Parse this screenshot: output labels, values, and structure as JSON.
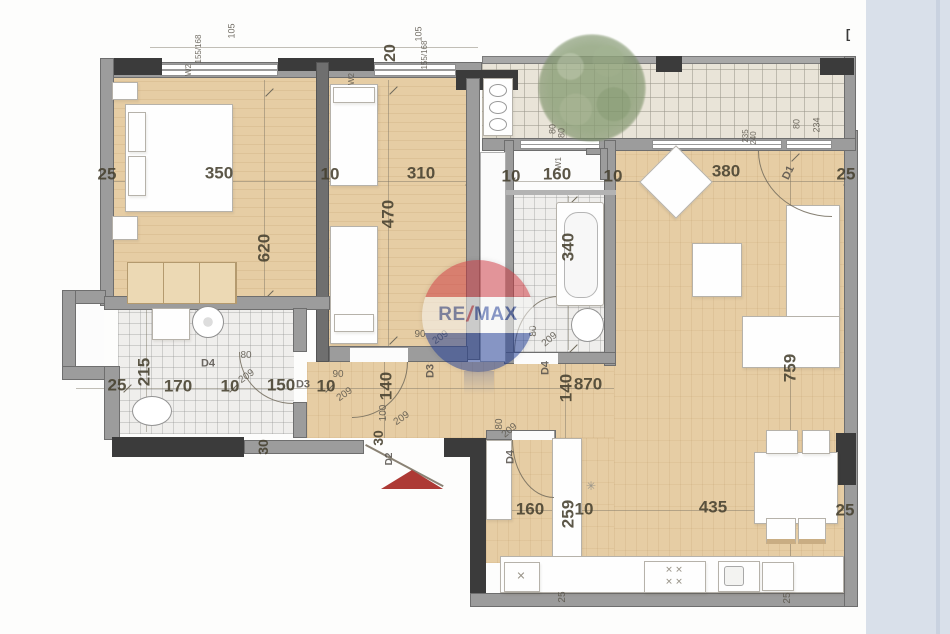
{
  "watermark": {
    "re": "RE",
    "slash": "/",
    "max": "MAX"
  },
  "entrance_marker": "red-triangle",
  "colors": {
    "floor_wood": "#e6cda4",
    "wall_gray": "#9c9c9c",
    "wall_dark": "#3b3b3b",
    "background_band": "#d9e0ea",
    "entrance_arrow": "#ad3a35",
    "watermark_red": "#cd3840",
    "watermark_blue": "#1c3a93",
    "tree_green": "#87a070"
  },
  "labels": [
    {
      "t": "350",
      "x": 219,
      "y": 173,
      "r": 0,
      "s": 17,
      "k": "dim"
    },
    {
      "t": "10",
      "x": 330,
      "y": 174,
      "r": 0,
      "s": 17,
      "k": "dim"
    },
    {
      "t": "310",
      "x": 421,
      "y": 173,
      "r": 0,
      "s": 17,
      "k": "dim"
    },
    {
      "t": "10",
      "x": 511,
      "y": 176,
      "r": 0,
      "s": 17,
      "k": "dim"
    },
    {
      "t": "160",
      "x": 557,
      "y": 174,
      "r": 0,
      "s": 17,
      "k": "dim"
    },
    {
      "t": "10",
      "x": 613,
      "y": 176,
      "r": 0,
      "s": 17,
      "k": "dim"
    },
    {
      "t": "380",
      "x": 726,
      "y": 171,
      "r": 0,
      "s": 17,
      "k": "dim"
    },
    {
      "t": "25",
      "x": 846,
      "y": 174,
      "r": 0,
      "s": 17,
      "k": "dim"
    },
    {
      "t": "25",
      "x": 107,
      "y": 174,
      "r": 0,
      "s": 17,
      "k": "dim"
    },
    {
      "t": "620",
      "x": 264,
      "y": 248,
      "r": -90,
      "s": 17,
      "k": "dim"
    },
    {
      "t": "470",
      "x": 388,
      "y": 214,
      "r": -90,
      "s": 17,
      "k": "dim"
    },
    {
      "t": "340",
      "x": 568,
      "y": 247,
      "r": -90,
      "s": 17,
      "k": "dim"
    },
    {
      "t": "215",
      "x": 144,
      "y": 372,
      "r": -90,
      "s": 17,
      "k": "dim"
    },
    {
      "t": "25",
      "x": 117,
      "y": 385,
      "r": 0,
      "s": 17,
      "k": "dim"
    },
    {
      "t": "170",
      "x": 178,
      "y": 386,
      "r": 0,
      "s": 17,
      "k": "dim"
    },
    {
      "t": "10",
      "x": 230,
      "y": 386,
      "r": 0,
      "s": 17,
      "k": "dim"
    },
    {
      "t": "150",
      "x": 281,
      "y": 385,
      "r": 0,
      "s": 17,
      "k": "dim"
    },
    {
      "t": "10",
      "x": 326,
      "y": 386,
      "r": 0,
      "s": 17,
      "k": "dim"
    },
    {
      "t": "140",
      "x": 386,
      "y": 386,
      "r": -90,
      "s": 17,
      "k": "dim"
    },
    {
      "t": "870",
      "x": 588,
      "y": 384,
      "r": 0,
      "s": 17,
      "k": "dim"
    },
    {
      "t": "140",
      "x": 566,
      "y": 388,
      "r": -90,
      "s": 17,
      "k": "dim"
    },
    {
      "t": "759",
      "x": 790,
      "y": 368,
      "r": -90,
      "s": 17,
      "k": "dim"
    },
    {
      "t": "25",
      "x": 845,
      "y": 510,
      "r": 0,
      "s": 17,
      "k": "dim"
    },
    {
      "t": "160",
      "x": 530,
      "y": 509,
      "r": 0,
      "s": 17,
      "k": "dim"
    },
    {
      "t": "259",
      "x": 568,
      "y": 514,
      "r": -90,
      "s": 17,
      "k": "dim"
    },
    {
      "t": "10",
      "x": 584,
      "y": 509,
      "r": 0,
      "s": 17,
      "k": "dim"
    },
    {
      "t": "435",
      "x": 713,
      "y": 507,
      "r": 0,
      "s": 17,
      "k": "dim"
    },
    {
      "t": "30",
      "x": 263,
      "y": 447,
      "r": -90,
      "s": 14,
      "k": "dim"
    },
    {
      "t": "30",
      "x": 378,
      "y": 438,
      "r": -90,
      "s": 14,
      "k": "dim"
    },
    {
      "t": "20",
      "x": 391,
      "y": 53,
      "r": -90,
      "s": 16,
      "k": "dim"
    },
    {
      "t": "105",
      "x": 232,
      "y": 31,
      "r": -90,
      "s": 9,
      "k": "small"
    },
    {
      "t": "105",
      "x": 419,
      "y": 34,
      "r": -90,
      "s": 9,
      "k": "small"
    },
    {
      "t": "155/168",
      "x": 199,
      "y": 49,
      "r": -90,
      "s": 8,
      "k": "small"
    },
    {
      "t": "155/168",
      "x": 425,
      "y": 55,
      "r": -90,
      "s": 8,
      "k": "small"
    },
    {
      "t": "W2",
      "x": 189,
      "y": 70,
      "r": -90,
      "s": 8,
      "k": "small"
    },
    {
      "t": "W2",
      "x": 352,
      "y": 79,
      "r": -90,
      "s": 8,
      "k": "small"
    },
    {
      "t": "W1",
      "x": 559,
      "y": 163,
      "r": -90,
      "s": 8,
      "k": "small"
    },
    {
      "t": "80",
      "x": 553,
      "y": 129,
      "r": -90,
      "s": 9,
      "k": "small"
    },
    {
      "t": "80",
      "x": 562,
      "y": 133,
      "r": -90,
      "s": 9,
      "k": "small"
    },
    {
      "t": "235",
      "x": 746,
      "y": 136,
      "r": -90,
      "s": 8,
      "k": "small"
    },
    {
      "t": "240",
      "x": 754,
      "y": 138,
      "r": -90,
      "s": 8,
      "k": "small"
    },
    {
      "t": "80",
      "x": 797,
      "y": 124,
      "r": -90,
      "s": 9,
      "k": "small"
    },
    {
      "t": "234",
      "x": 817,
      "y": 125,
      "r": -90,
      "s": 9,
      "k": "small"
    },
    {
      "t": "25",
      "x": 563,
      "y": 597,
      "r": -90,
      "s": 10,
      "k": "small"
    },
    {
      "t": "25",
      "x": 788,
      "y": 598,
      "r": -90,
      "s": 10,
      "k": "small"
    },
    {
      "t": "80",
      "x": 246,
      "y": 356,
      "r": 0,
      "s": 10,
      "k": "small"
    },
    {
      "t": "209",
      "x": 247,
      "y": 377,
      "r": -35,
      "s": 10,
      "k": "small"
    },
    {
      "t": "90",
      "x": 338,
      "y": 375,
      "r": 0,
      "s": 10,
      "k": "small"
    },
    {
      "t": "209",
      "x": 345,
      "y": 395,
      "r": -35,
      "s": 10,
      "k": "small"
    },
    {
      "t": "90",
      "x": 420,
      "y": 335,
      "r": 0,
      "s": 10,
      "k": "small"
    },
    {
      "t": "209",
      "x": 441,
      "y": 338,
      "r": -35,
      "s": 10,
      "k": "small"
    },
    {
      "t": "80",
      "x": 534,
      "y": 331,
      "r": -90,
      "s": 10,
      "k": "small"
    },
    {
      "t": "209",
      "x": 550,
      "y": 340,
      "r": -40,
      "s": 10,
      "k": "small"
    },
    {
      "t": "100",
      "x": 384,
      "y": 413,
      "r": -90,
      "s": 10,
      "k": "small"
    },
    {
      "t": "209",
      "x": 402,
      "y": 419,
      "r": -35,
      "s": 10,
      "k": "small"
    },
    {
      "t": "80",
      "x": 500,
      "y": 424,
      "r": -90,
      "s": 10,
      "k": "small"
    },
    {
      "t": "209",
      "x": 510,
      "y": 431,
      "r": -40,
      "s": 10,
      "k": "small"
    },
    {
      "t": "D4",
      "x": 208,
      "y": 364,
      "r": 0,
      "s": 11,
      "k": "door"
    },
    {
      "t": "D3",
      "x": 303,
      "y": 385,
      "r": 0,
      "s": 11,
      "k": "door"
    },
    {
      "t": "D3",
      "x": 431,
      "y": 371,
      "r": -90,
      "s": 11,
      "k": "door"
    },
    {
      "t": "D4",
      "x": 546,
      "y": 368,
      "r": -90,
      "s": 11,
      "k": "door"
    },
    {
      "t": "D2",
      "x": 390,
      "y": 459,
      "r": -90,
      "s": 10,
      "k": "door"
    },
    {
      "t": "D4",
      "x": 511,
      "y": 457,
      "r": -90,
      "s": 11,
      "k": "door"
    },
    {
      "t": "D1",
      "x": 789,
      "y": 173,
      "r": -65,
      "s": 11,
      "k": "door"
    },
    {
      "t": "[",
      "x": 848,
      "y": 34,
      "r": 0,
      "s": 13,
      "k": "mark"
    },
    {
      "t": "✳",
      "x": 591,
      "y": 486,
      "r": 0,
      "s": 12,
      "k": "sym"
    },
    {
      "t": "✕",
      "x": 521,
      "y": 577,
      "r": 0,
      "s": 11,
      "k": "sym"
    },
    {
      "t": "✕ ✕",
      "x": 674,
      "y": 570,
      "r": 0,
      "s": 9,
      "k": "sym"
    },
    {
      "t": "✕ ✕",
      "x": 674,
      "y": 582,
      "r": 0,
      "s": 9,
      "k": "sym"
    }
  ]
}
